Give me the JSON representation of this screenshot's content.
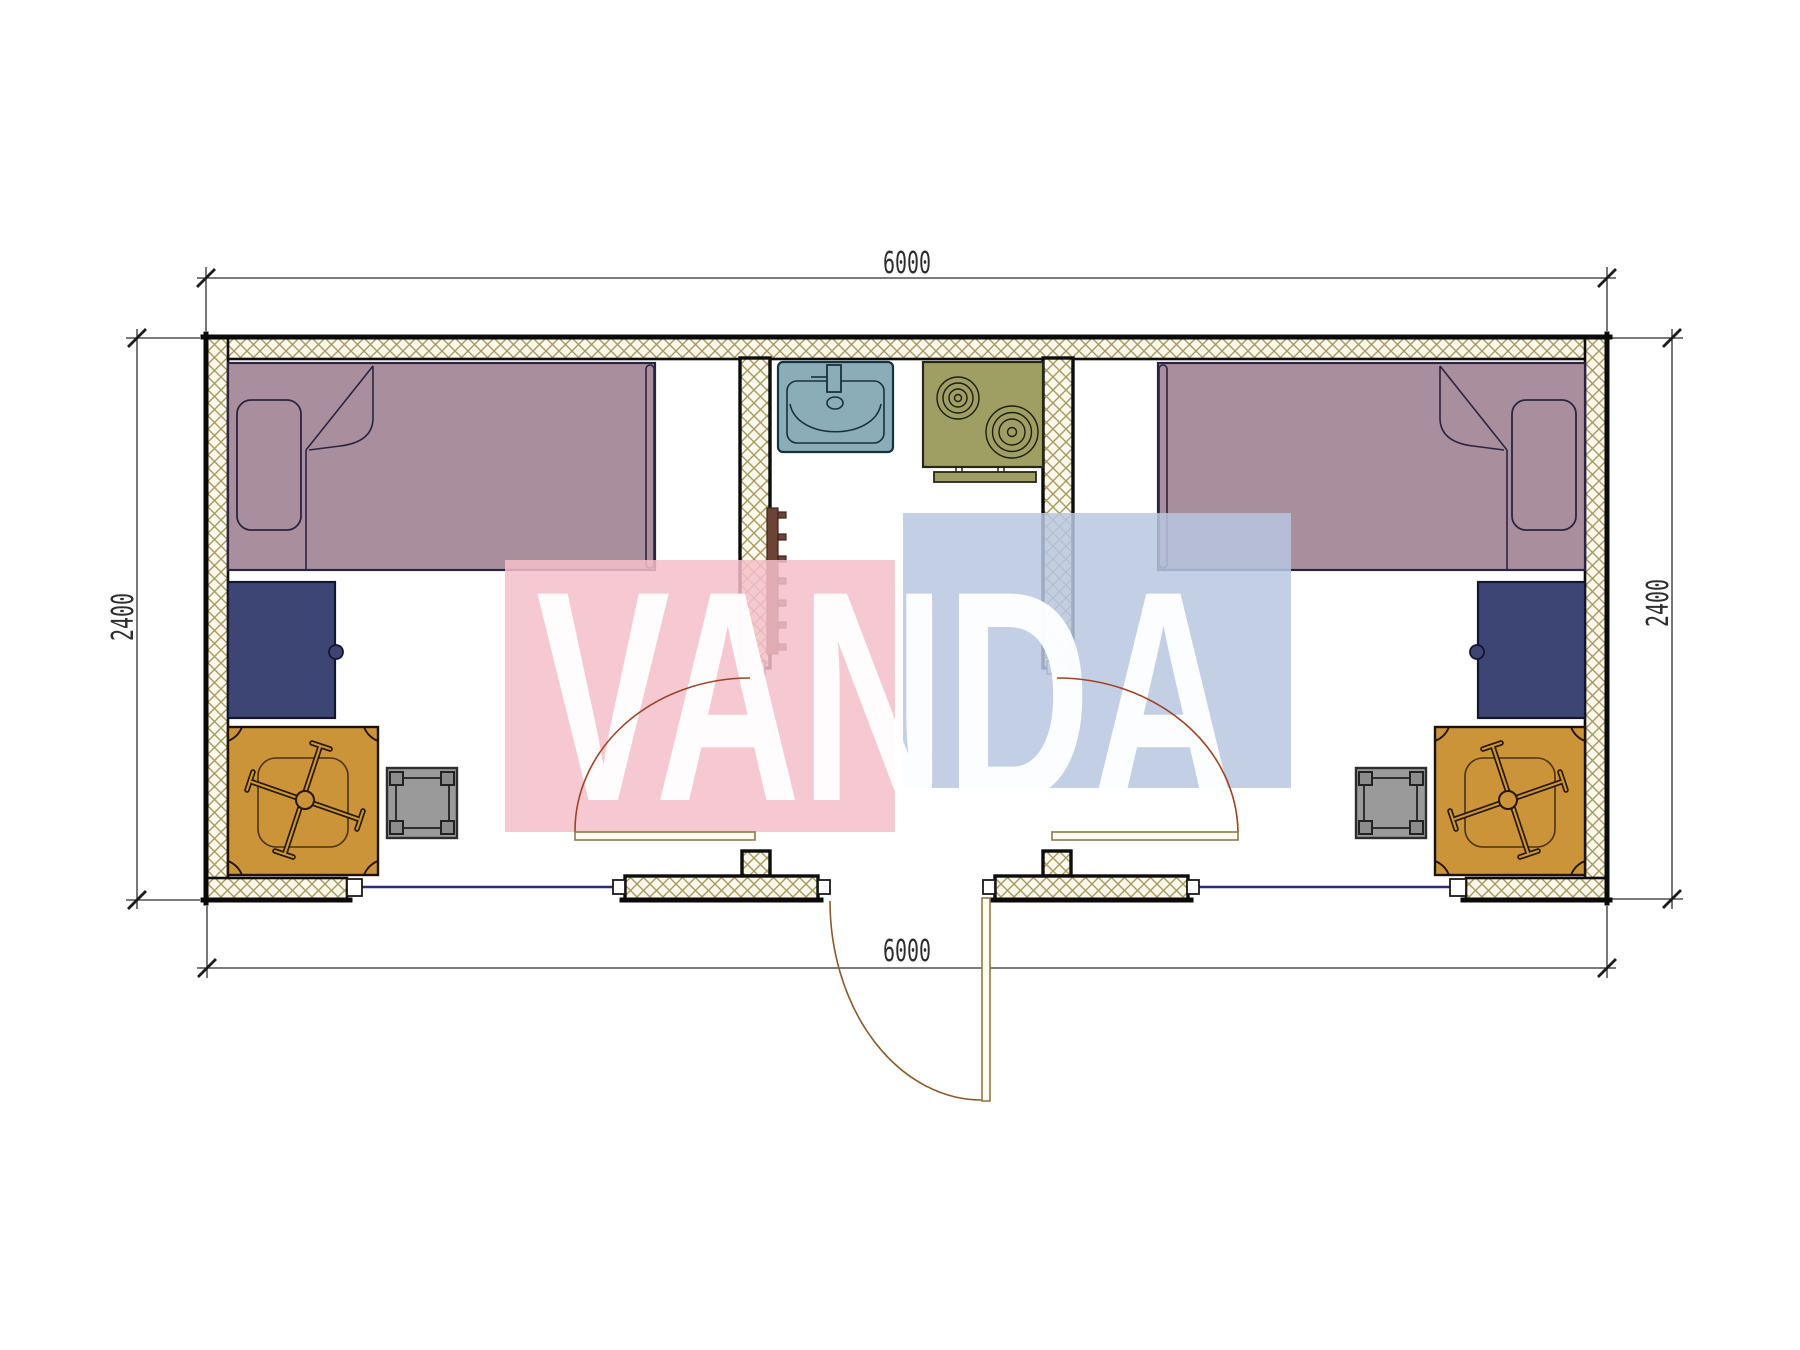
{
  "watermark": {
    "text": "VANDA",
    "pink": "#f5bfca",
    "blue": "#b9c7e1",
    "letter_color": "#ffffff"
  },
  "dimensions": {
    "top": "6000",
    "bottom": "6000",
    "left": "2400",
    "right": "2400"
  },
  "palette": {
    "hatch_bg": "#fbf7ea",
    "hatch_line": "#a59a62",
    "bed": "#a98f9d",
    "desk": "#3d4575",
    "chair": "#cc9439",
    "chair_dark": "#241703",
    "stool": "#9a9a9a",
    "stool_leg": "#8c8c8c",
    "sink": "#8badb8",
    "stove": "#9f9f63",
    "radiator": "#6d4237",
    "window": "#2b2b85",
    "door_leaf_fill": "#fefcf2",
    "door_leaf_stroke": "#8f7a45",
    "door_arc": "#8a5a2b",
    "interior_door_arc": "#9c4423",
    "cap_fill": "#ffffff"
  }
}
